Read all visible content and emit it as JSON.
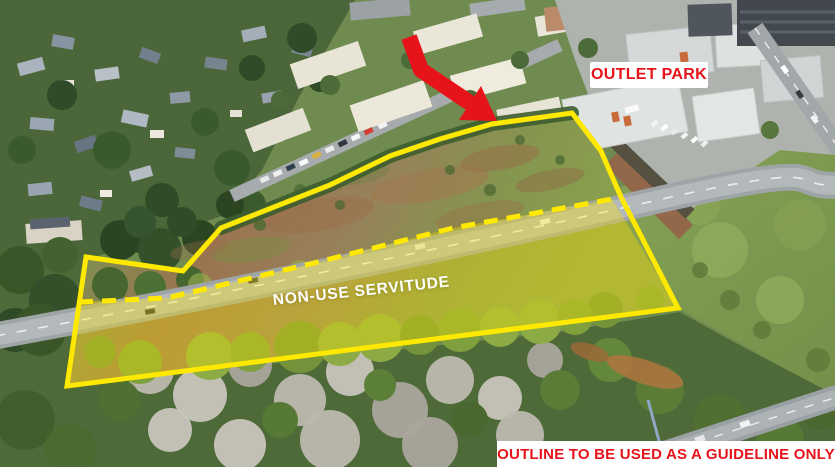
{
  "meta": {
    "description": "Aerial drone photograph of a vacant land parcel outlined in yellow beside the Outlet Park retail centre, with a non-use servitude strip highlighted along the main road"
  },
  "labels": {
    "outlet_park": "OUTLET PARK",
    "servitude": "NON-USE SERVITUDE",
    "disclaimer": "OUTLINE TO BE USED AS A GUIDELINE ONLY"
  },
  "colors": {
    "outline_yellow": "#FFE900",
    "servitude_tint": "rgba(255,232,0,0.34)",
    "arrow_red": "#E6131A",
    "label_red": "#E6131A",
    "label_background": "#FFFFFF"
  },
  "overlay": {
    "outline_points": "572,113 601,151 621,197 678,308 67,386 86,257 183,271 221,228 330,185 390,156 440,139 492,124",
    "dashed_points": "79,302 167,298 310,264 453,228 580,205 612,199",
    "tint_points": "79,302 167,298 310,264 453,228 580,205 612,199 678,308 67,386",
    "dash_pattern": "14 9",
    "arrow_shaft_points": "409,37 421,70 470,103",
    "arrow_head_points": "481,86 497,121 459,120"
  }
}
